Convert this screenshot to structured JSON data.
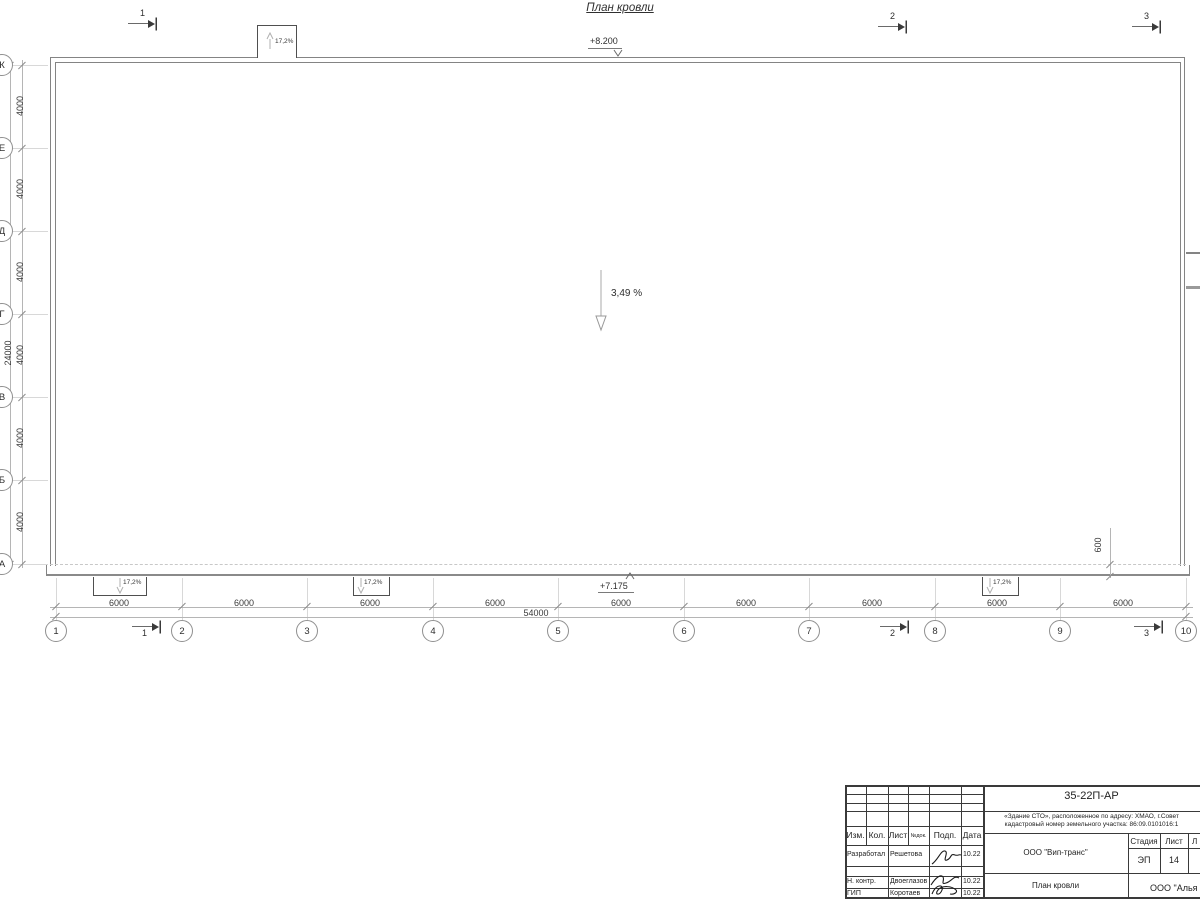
{
  "title": "План кровли",
  "colors": {
    "wall": "#848484",
    "canopy_line": "#4f4f4f",
    "dim_line": "#b5b5b5",
    "text": "#2f2f2f",
    "titleblock_line": "#3a3a3a"
  },
  "sections": [
    "1",
    "2",
    "3"
  ],
  "marks": {
    "elev_top": "+8.200",
    "elev_bottom": "+7.175",
    "slope_main": "3,49 %",
    "canopy_slope": "17,2%",
    "overhang": "600"
  },
  "axes_h": {
    "labels": [
      "1",
      "2",
      "3",
      "4",
      "5",
      "6",
      "7",
      "8",
      "9",
      "10"
    ],
    "bay": "6000",
    "total": "54000"
  },
  "axes_v": {
    "labels": [
      "К",
      "Е",
      "Д",
      "Г",
      "В",
      "Б",
      "А"
    ],
    "bay": "4000",
    "total": "24000"
  },
  "titleblock": {
    "code": "35-22П-АР",
    "object_line1": "«Здание СТО», расположенное по адресу: ХМАО, г.Совет",
    "object_line2": "кадастровый номер земельного участка: 86:09.0101016:1",
    "columns": [
      "Изм.",
      "Кол.",
      "Лист",
      "№док.",
      "Подп.",
      "Дата"
    ],
    "rows": [
      {
        "role": "Разработал",
        "name": "Решетова",
        "date": "10.22"
      },
      {
        "role": "Н. контр.",
        "name": "Двоеглазов",
        "date": "10.22"
      },
      {
        "role": "ГИП",
        "name": "Коротаев",
        "date": "10.22"
      }
    ],
    "org": "ООО \"Вип-транс\"",
    "sheet_name": "План кровли",
    "org2": "ООО \"Алья",
    "stage_label": "Стадия",
    "sheet_label": "Лист",
    "sheets_label": "Л",
    "stage": "ЭП",
    "sheet": "14"
  }
}
